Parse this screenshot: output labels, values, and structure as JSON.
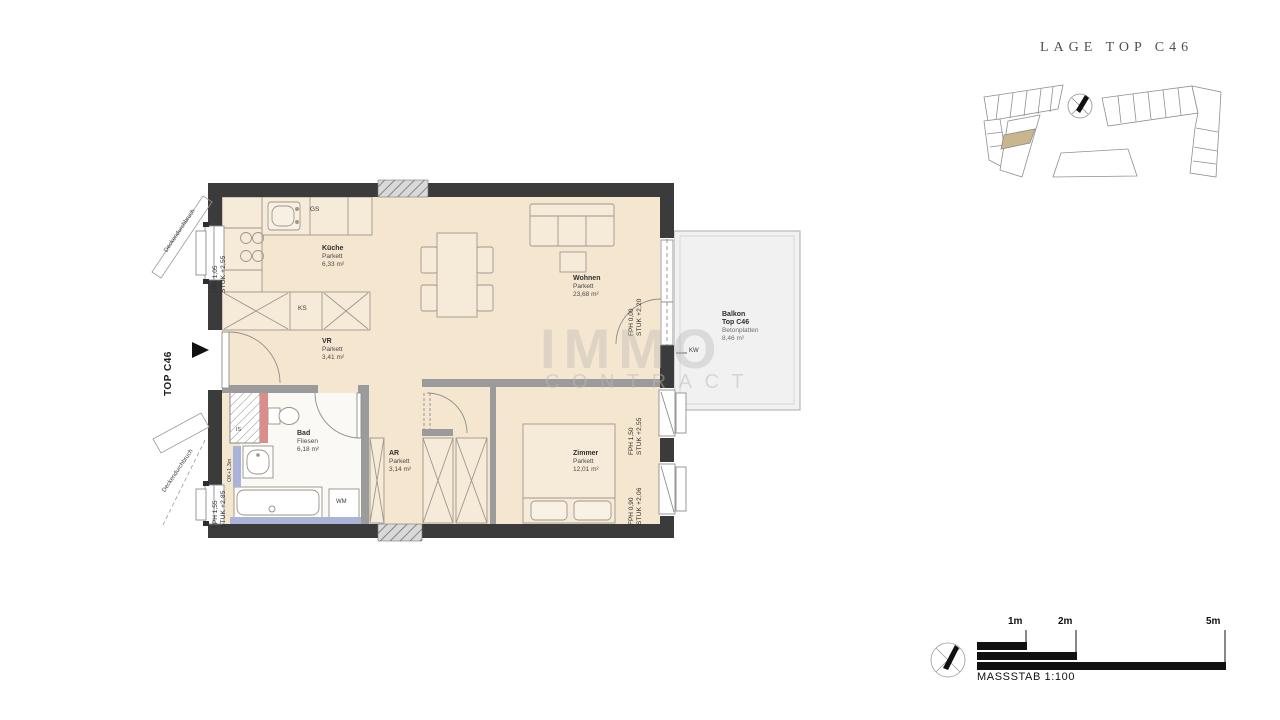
{
  "header": {
    "title": "LAGE TOP C46"
  },
  "floor_plan": {
    "unit_marker": "TOP C46",
    "rooms": {
      "kueche": {
        "name": "Küche",
        "floor": "Parkett",
        "area": "6,33 m²"
      },
      "wohnen": {
        "name": "Wohnen",
        "floor": "Parkett",
        "area": "23,68 m²"
      },
      "vr": {
        "name": "VR",
        "floor": "Parkett",
        "area": "3,41 m²"
      },
      "bad": {
        "name": "Bad",
        "floor": "Fliesen",
        "area": "6,18 m²"
      },
      "ar": {
        "name": "AR",
        "floor": "Parkett",
        "area": "3,14 m²"
      },
      "zimmer": {
        "name": "Zimmer",
        "floor": "Parkett",
        "area": "12,01 m²"
      },
      "balkon": {
        "name": "Balkon",
        "unit": "Top C46",
        "floor": "Betonplatten",
        "area": "8,46 m²"
      }
    },
    "fixtures": {
      "gs": "GS",
      "ks": "KS",
      "wm": "WM",
      "is": "IS",
      "kw": "KW",
      "ok": "OK+1,3m"
    },
    "windows": [
      {
        "fph": "FPH 1,05",
        "stuk": "STUK +2,55"
      },
      {
        "fph": "FPH 1,55",
        "stuk": "STUK +2,85"
      },
      {
        "fph": "FPH 0,00",
        "stuk": "STUK +2,20"
      },
      {
        "fph": "FPH 1,50",
        "stuk": "STUK +2,55"
      },
      {
        "fph": "FPH 0,90",
        "stuk": "STUK +2,06"
      }
    ],
    "notes": {
      "deckendurchbruch": "Deckendurchbruch"
    }
  },
  "scale_bar": {
    "marks": [
      "1m",
      "2m",
      "5m"
    ],
    "label": "MASSSTAB 1:100"
  },
  "watermark": {
    "line1": "IMMO",
    "line2": "CONTRACT"
  },
  "colors": {
    "wall": "#3b3b3b",
    "interior_wall": "#9b9b9b",
    "floor": "#f5e6cf",
    "bath_floor": "#fbf9f5",
    "balcony": "#f1f1f1",
    "furniture": "#f6ebd9",
    "highlight": "#c9b68e",
    "plumbing_red": "#d98d8d",
    "plumbing_blue": "#a9b4d8"
  }
}
